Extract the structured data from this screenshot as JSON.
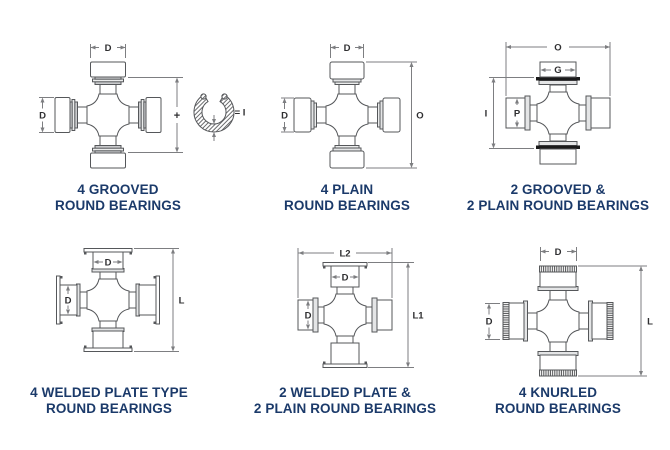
{
  "page": {
    "background": "#ffffff",
    "type": "bearing-cross-reference-diagrams"
  },
  "colors": {
    "caption": "#1b3a6a",
    "part_line": "#55575a",
    "dimension_line": "#7d7e81",
    "label": "#2f2f31",
    "snap_ring_black": "#1a1a1a",
    "band_gray": "#c9cacc"
  },
  "figures": [
    {
      "caption1": "4 GROOVED",
      "caption2": "ROUND BEARINGS",
      "labels": {
        "top": "D",
        "left": "D",
        "plus": "+",
        "equals": "= I"
      }
    },
    {
      "caption1": "4 PLAIN",
      "caption2": "ROUND BEARINGS",
      "labels": {
        "top": "D",
        "left": "D",
        "right": "O"
      }
    },
    {
      "caption1": "2 GROOVED &",
      "caption2": "2 PLAIN ROUND BEARINGS",
      "labels": {
        "top": "O",
        "cup": "G",
        "left": "I",
        "cup2": "P"
      }
    },
    {
      "caption1": "4 WELDED PLATE TYPE",
      "caption2": "ROUND BEARINGS",
      "labels": {
        "top": "D",
        "left": "D",
        "right": "L"
      }
    },
    {
      "caption1": "2 WELDED PLATE &",
      "caption2": "2 PLAIN ROUND BEARINGS",
      "labels": {
        "top": "L2",
        "cup": "D",
        "left": "D",
        "right": "L1"
      }
    },
    {
      "caption1": "4 KNURLED",
      "caption2": "ROUND BEARINGS",
      "labels": {
        "top": "D",
        "left": "D",
        "right": "L"
      }
    }
  ]
}
